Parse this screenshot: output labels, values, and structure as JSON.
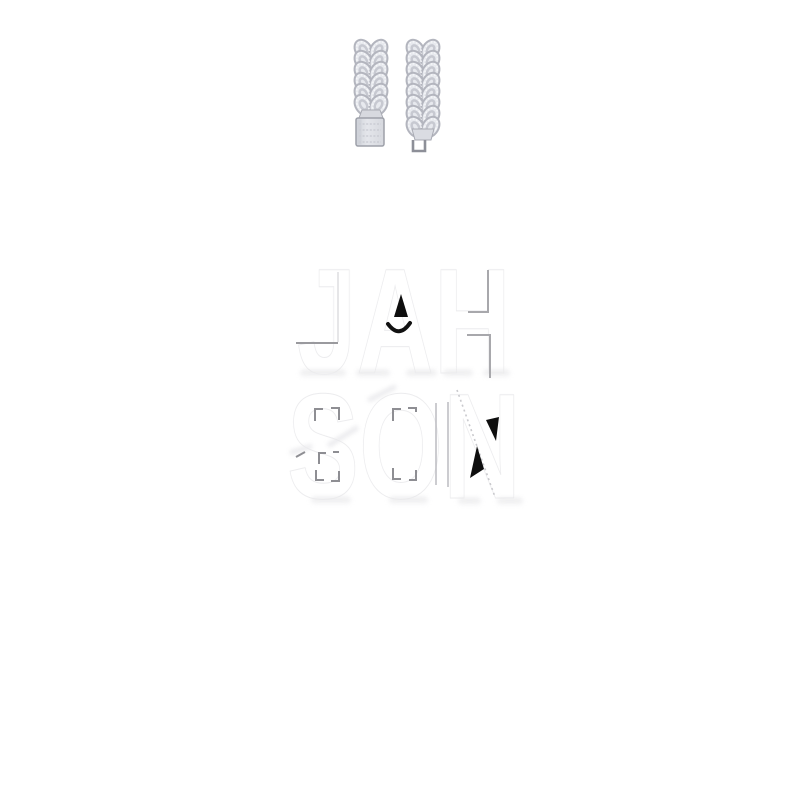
{
  "page": {
    "background_color": "#ffffff"
  },
  "product_photo": {
    "subject": "iced cuban link chain bracelet, two open strand ends",
    "strand_count": 2,
    "left_strand_end": "box clasp",
    "right_strand_end": "clasp tongue",
    "metal_color": "#e7e9ee",
    "metal_shadow_color": "#b3b5be",
    "metal_dark_color": "#8d8f98"
  },
  "watermark": {
    "line1": "JAH",
    "line2": "SON",
    "fill_color": "#ffffff",
    "outline_color": "#ececee",
    "accent_color": "#0e0e0e",
    "fragment_color": "#9a9a9e",
    "shadow_color": "#e3e3e5"
  }
}
